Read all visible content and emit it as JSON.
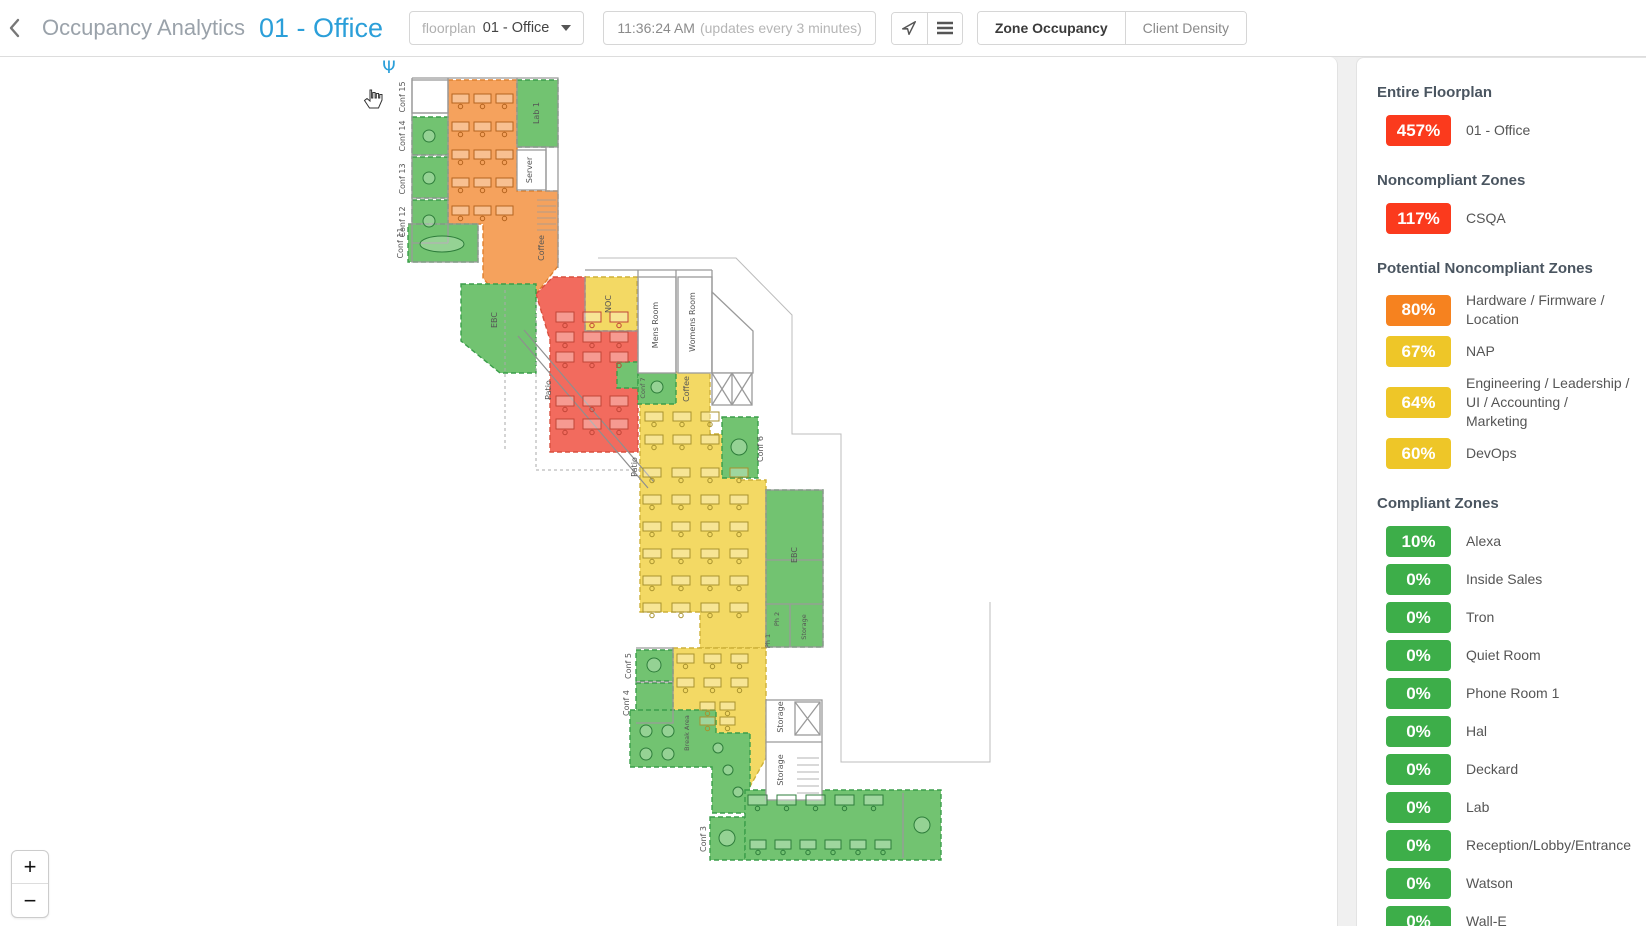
{
  "header": {
    "back_icon": "‹",
    "app_title": "Occupancy Analytics",
    "page_title": "01 - Office",
    "floorplan_select": {
      "label": "floorplan",
      "value": "01 - Office"
    },
    "time_display": {
      "time": "11:36:24 AM",
      "note": "(updates every 3 minutes)"
    },
    "view_buttons": [
      {
        "label": "Zone Occupancy",
        "active": true
      },
      {
        "label": "Client Density",
        "active": false
      }
    ]
  },
  "map": {
    "zoom_in": "+",
    "zoom_out": "−",
    "labels": {
      "conf15": "Conf 15",
      "conf14": "Conf 14",
      "conf13": "Conf 13",
      "conf12": "Conf 12",
      "conf11": "Conf 11",
      "lab1": "Lab 1",
      "server": "Server",
      "coffee1": "Coffee",
      "coffee2": "Coffee",
      "ebc1": "EBC",
      "ebc2": "EBC",
      "noc": "NOC",
      "mens": "Mens Room",
      "womens": "Womens Room",
      "conf7": "Conf 7",
      "conf6": "Conf 6",
      "conf5": "Conf 5",
      "conf4": "Conf 4",
      "conf3": "Conf 3",
      "patio1": "Patio",
      "patio2": "Patio",
      "ph1": "Ph 1",
      "ph2": "Ph 2",
      "storage1": "Storage",
      "storage2": "Storage",
      "storage3": "Storage",
      "breakarea": "Break Area"
    },
    "desk_grids": [
      {
        "x": 452,
        "y": 94,
        "cols": 3,
        "rows": 5,
        "w": 17,
        "h": 9,
        "dx": 22,
        "dy": 28,
        "cls": "o"
      },
      {
        "x": 556,
        "y": 312,
        "cols": 3,
        "rows": 3,
        "w": 18,
        "h": 10,
        "dx": 27,
        "dy": 20,
        "cls": "r"
      },
      {
        "x": 556,
        "y": 396,
        "cols": 3,
        "rows": 2,
        "w": 18,
        "h": 10,
        "dx": 27,
        "dy": 23,
        "cls": "r"
      },
      {
        "x": 645,
        "y": 412,
        "cols": 3,
        "rows": 2,
        "w": 18,
        "h": 9,
        "dx": 28,
        "dy": 23,
        "cls": "y"
      },
      {
        "x": 643,
        "y": 468,
        "cols": 4,
        "rows": 6,
        "w": 18,
        "h": 9,
        "dx": 29,
        "dy": 27,
        "cls": "y"
      },
      {
        "x": 677,
        "y": 654,
        "cols": 3,
        "rows": 2,
        "w": 17,
        "h": 9,
        "dx": 27,
        "dy": 24,
        "cls": "y"
      },
      {
        "x": 700,
        "y": 702,
        "cols": 2,
        "rows": 2,
        "w": 15,
        "h": 8,
        "dx": 20,
        "dy": 15,
        "cls": "y"
      },
      {
        "x": 748,
        "y": 795,
        "cols": 5,
        "rows": 1,
        "w": 19,
        "h": 10,
        "dx": 29,
        "dy": 0,
        "cls": "g"
      },
      {
        "x": 750,
        "y": 840,
        "cols": 6,
        "rows": 1,
        "w": 16,
        "h": 9,
        "dx": 25,
        "dy": 0,
        "cls": "g"
      }
    ],
    "round_tables": [
      {
        "x": 429,
        "y": 136,
        "r": 6,
        "cls": "g"
      },
      {
        "x": 429,
        "y": 178,
        "r": 6,
        "cls": "g"
      },
      {
        "x": 429,
        "y": 221,
        "r": 6,
        "cls": "g"
      },
      {
        "x": 657,
        "y": 387,
        "r": 6,
        "cls": "g"
      },
      {
        "x": 739,
        "y": 447,
        "r": 8,
        "cls": "g"
      },
      {
        "x": 654,
        "y": 665,
        "r": 7,
        "cls": "g"
      },
      {
        "x": 727,
        "y": 838,
        "r": 8,
        "cls": "g"
      },
      {
        "x": 646,
        "y": 731,
        "r": 6,
        "cls": "g"
      },
      {
        "x": 668,
        "y": 731,
        "r": 6,
        "cls": "g"
      },
      {
        "x": 646,
        "y": 754,
        "r": 6,
        "cls": "g"
      },
      {
        "x": 668,
        "y": 754,
        "r": 6,
        "cls": "g"
      },
      {
        "x": 922,
        "y": 825,
        "r": 8,
        "cls": "g"
      },
      {
        "x": 718,
        "y": 748,
        "r": 5,
        "cls": "g"
      },
      {
        "x": 728,
        "y": 770,
        "r": 5,
        "cls": "g"
      },
      {
        "x": 738,
        "y": 792,
        "r": 5,
        "cls": "g"
      }
    ]
  },
  "sidebar": {
    "sections": [
      {
        "heading": "Entire Floorplan",
        "items": [
          {
            "value": "457%",
            "label": "01 - Office",
            "color": "#fb3a1d"
          }
        ]
      },
      {
        "heading": "Noncompliant Zones",
        "items": [
          {
            "value": "117%",
            "label": "CSQA",
            "color": "#fb3a1d"
          }
        ]
      },
      {
        "heading": "Potential Noncompliant Zones",
        "items": [
          {
            "value": "80%",
            "label": "Hardware / Firmware / Location",
            "color": "#f6821f"
          },
          {
            "value": "67%",
            "label": "NAP",
            "color": "#eec628"
          },
          {
            "value": "64%",
            "label": "Engineering / Leadership / UI / Accounting / Marketing",
            "color": "#eec628"
          },
          {
            "value": "60%",
            "label": "DevOps",
            "color": "#eec628"
          }
        ]
      },
      {
        "heading": "Compliant Zones",
        "items": [
          {
            "value": "10%",
            "label": "Alexa",
            "color": "#3dae49"
          },
          {
            "value": "0%",
            "label": "Inside Sales",
            "color": "#3dae49"
          },
          {
            "value": "0%",
            "label": "Tron",
            "color": "#3dae49"
          },
          {
            "value": "0%",
            "label": "Quiet Room",
            "color": "#3dae49"
          },
          {
            "value": "0%",
            "label": "Phone Room 1",
            "color": "#3dae49"
          },
          {
            "value": "0%",
            "label": "Hal",
            "color": "#3dae49"
          },
          {
            "value": "0%",
            "label": "Deckard",
            "color": "#3dae49"
          },
          {
            "value": "0%",
            "label": "Lab",
            "color": "#3dae49"
          },
          {
            "value": "0%",
            "label": "Reception/Lobby/Entrance",
            "color": "#3dae49"
          },
          {
            "value": "0%",
            "label": "Watson",
            "color": "#3dae49"
          },
          {
            "value": "0%",
            "label": "Wall-E",
            "color": "#3dae49"
          }
        ]
      }
    ]
  },
  "colors": {
    "accent_blue": "#2b9fd9",
    "red": "#fb3a1d",
    "orange": "#f6821f",
    "yellow": "#eec628",
    "green": "#3dae49"
  }
}
